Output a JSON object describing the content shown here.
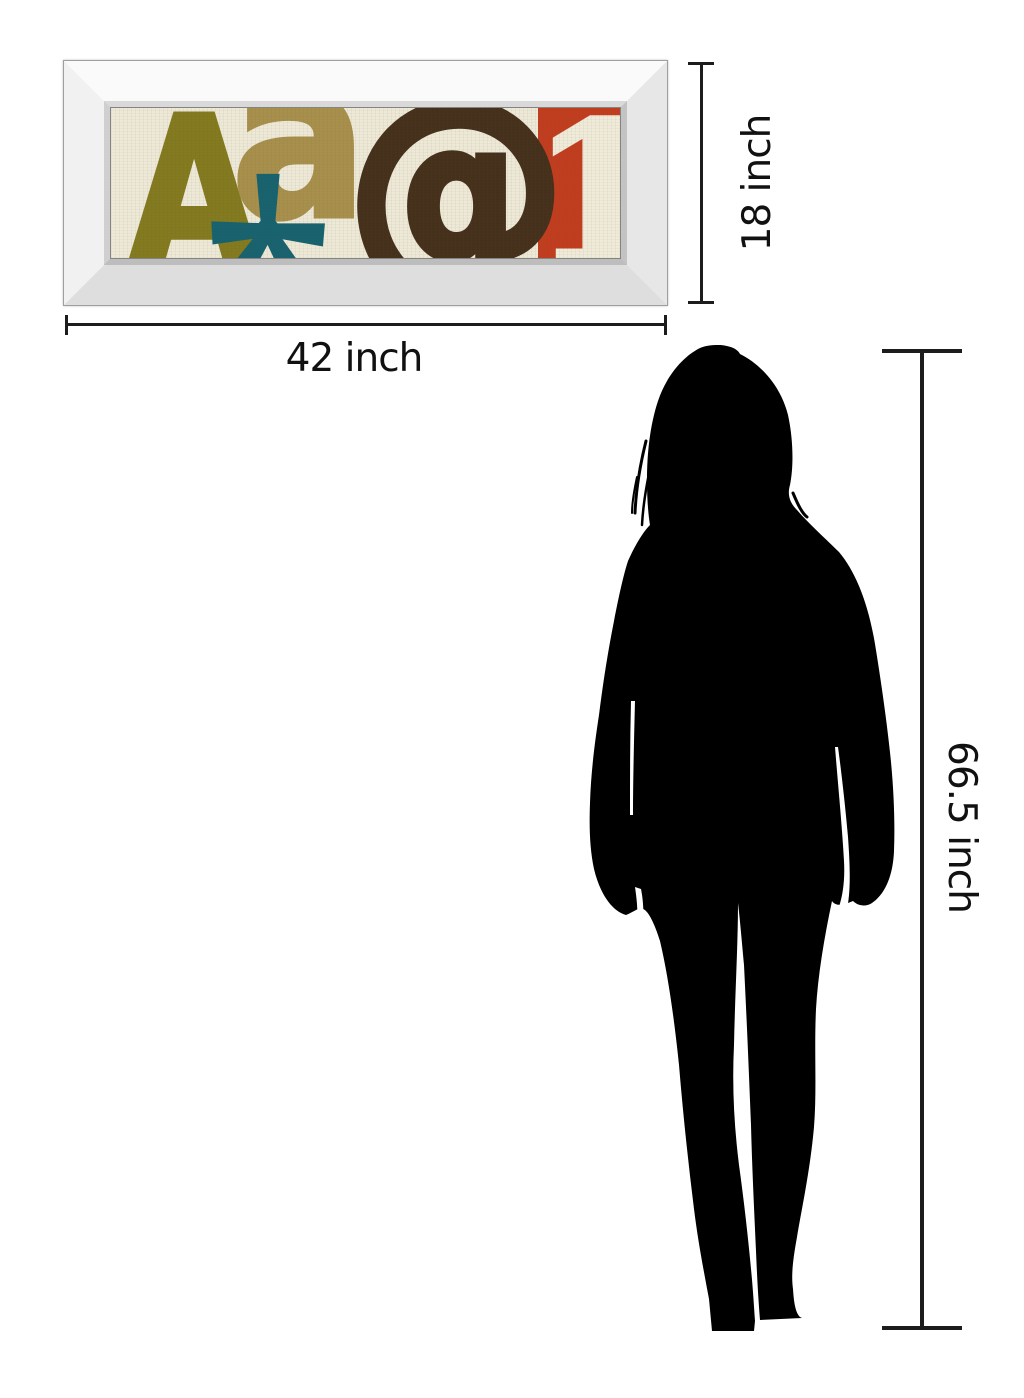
{
  "diagram": {
    "type": "product-size-comparison",
    "background": "#ffffff",
    "line_color": "#1c1c1c"
  },
  "artwork": {
    "frame_style": "white mirrored bevel frame",
    "frame_face_color": "#f4f4f4",
    "glyphs": {
      "A": "A",
      "a": "a",
      "asterisk": "*",
      "at": "@",
      "one": "1"
    },
    "colors": {
      "background": "#eee8d7",
      "letter_A": "#847a1f",
      "letter_a": "#a8904c",
      "asterisk": "#17626f",
      "at_sign": "#45301b",
      "numeral_block": "#c13d1e",
      "numeral": "#f0ead9"
    }
  },
  "dimensions": {
    "width": {
      "label": "42 inch",
      "value": 42,
      "unit": "inch"
    },
    "height": {
      "label": "18 inch",
      "value": 18,
      "unit": "inch"
    },
    "figure_height": {
      "label": "66.5 inch",
      "value": 66.5,
      "unit": "inch"
    }
  },
  "figure": {
    "name": "woman silhouette",
    "color": "#000000"
  }
}
